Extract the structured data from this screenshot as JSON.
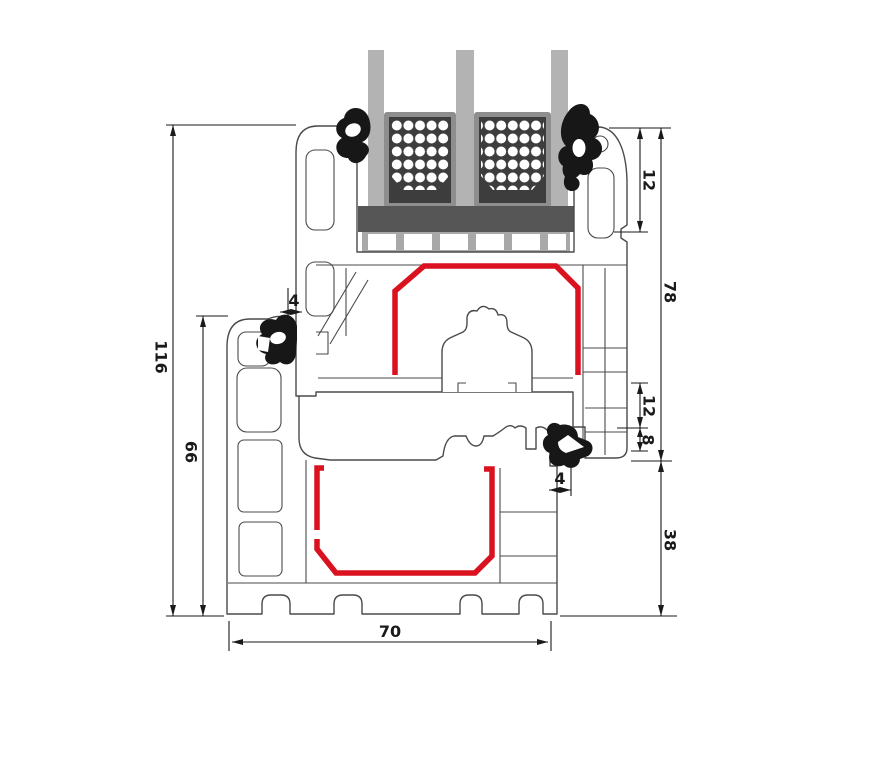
{
  "drawing": {
    "kind": "window-profile-cross-section"
  },
  "colors": {
    "background": "#ffffff",
    "profile_outline": "#4a4a4a",
    "dimension_line": "#1a1a1a",
    "steel_reinforcement_red": "#da121f",
    "gasket_black": "#171717",
    "glass_gray": "#b3b3b3",
    "spacer_frame_gray": "#8e8e8e",
    "spacer_core_dark": "#3d3d3d",
    "desiccant_dot": "#ffffff",
    "glazing_block_dark": "#565656",
    "glazing_packer_gray": "#a8a8a8"
  },
  "components": {
    "glass_pane_count": 3,
    "spacer_bar_count": 2,
    "gasket_count": 4,
    "steel_reinforcement_count": 2,
    "parts": [
      "frame-profile",
      "sash-profile",
      "triple-glazing",
      "glazing-spacer-bars",
      "glazing-blocks",
      "euro-groove",
      "rubber-gaskets",
      "steel-reinforcements"
    ]
  },
  "dims": {
    "d116": "116",
    "d66": "66",
    "d70": "70",
    "d78": "78",
    "d12_top": "12",
    "d12_mid": "12",
    "d8": "8",
    "d38": "38",
    "d4_left": "4",
    "d4_right": "4"
  }
}
